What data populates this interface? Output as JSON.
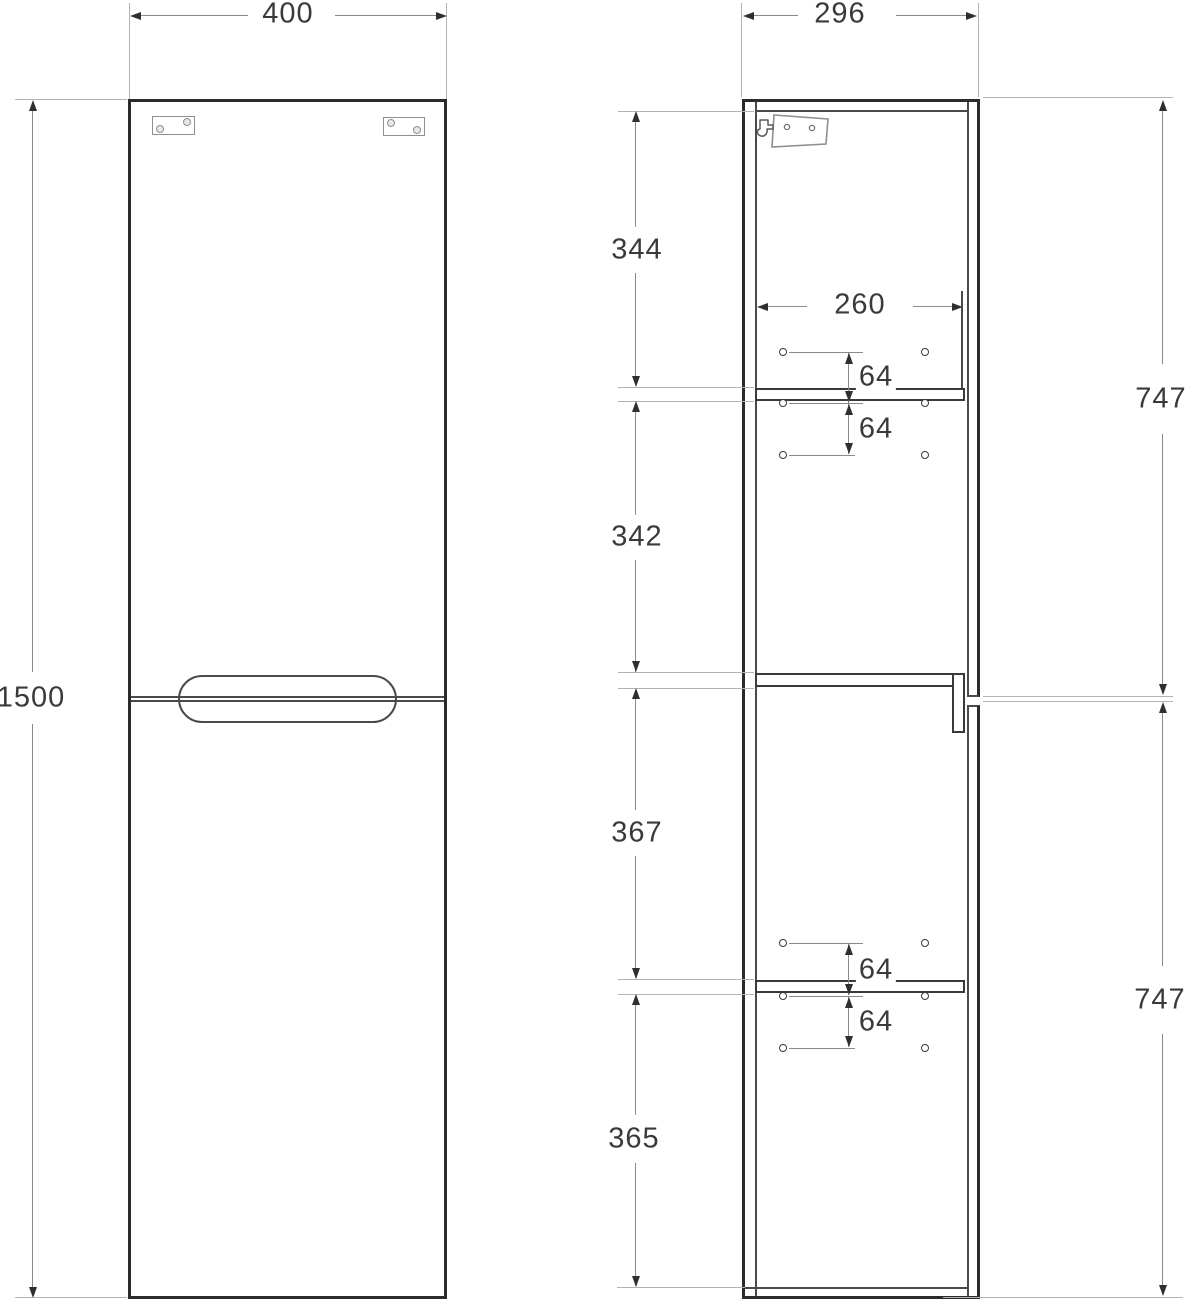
{
  "drawing_title": "Tall cabinet technical drawing (front and side elevations)",
  "dims": {
    "front_width": "400",
    "front_height": "1500",
    "side_depth": "296",
    "shelf_depth": "260",
    "top_to_shelf": "344",
    "shelf_to_divider": "342",
    "divider_to_lower_shelf": "367",
    "lower_shelf_to_bottom": "365",
    "hole_pitch_upper_1": "64",
    "hole_pitch_upper_2": "64",
    "hole_pitch_lower_1": "64",
    "hole_pitch_lower_2": "64",
    "upper_door_height": "747",
    "lower_door_height": "747"
  },
  "icons": {
    "hinge": "hinge-plate-icon",
    "wall_bracket": "wall-bracket-icon",
    "hanger_hook": "hanger-hook-icon",
    "shelf_pin_hole": "shelf-pin-hole-icon"
  },
  "colors": {
    "outline": "#2b2b2b",
    "inner_line": "#4a4a4a",
    "dimension_line": "#8a8a8a",
    "extension_line": "#b3b3b3",
    "arrow": "#2f2f2f",
    "text": "#3a3a3a",
    "background": "#ffffff"
  }
}
